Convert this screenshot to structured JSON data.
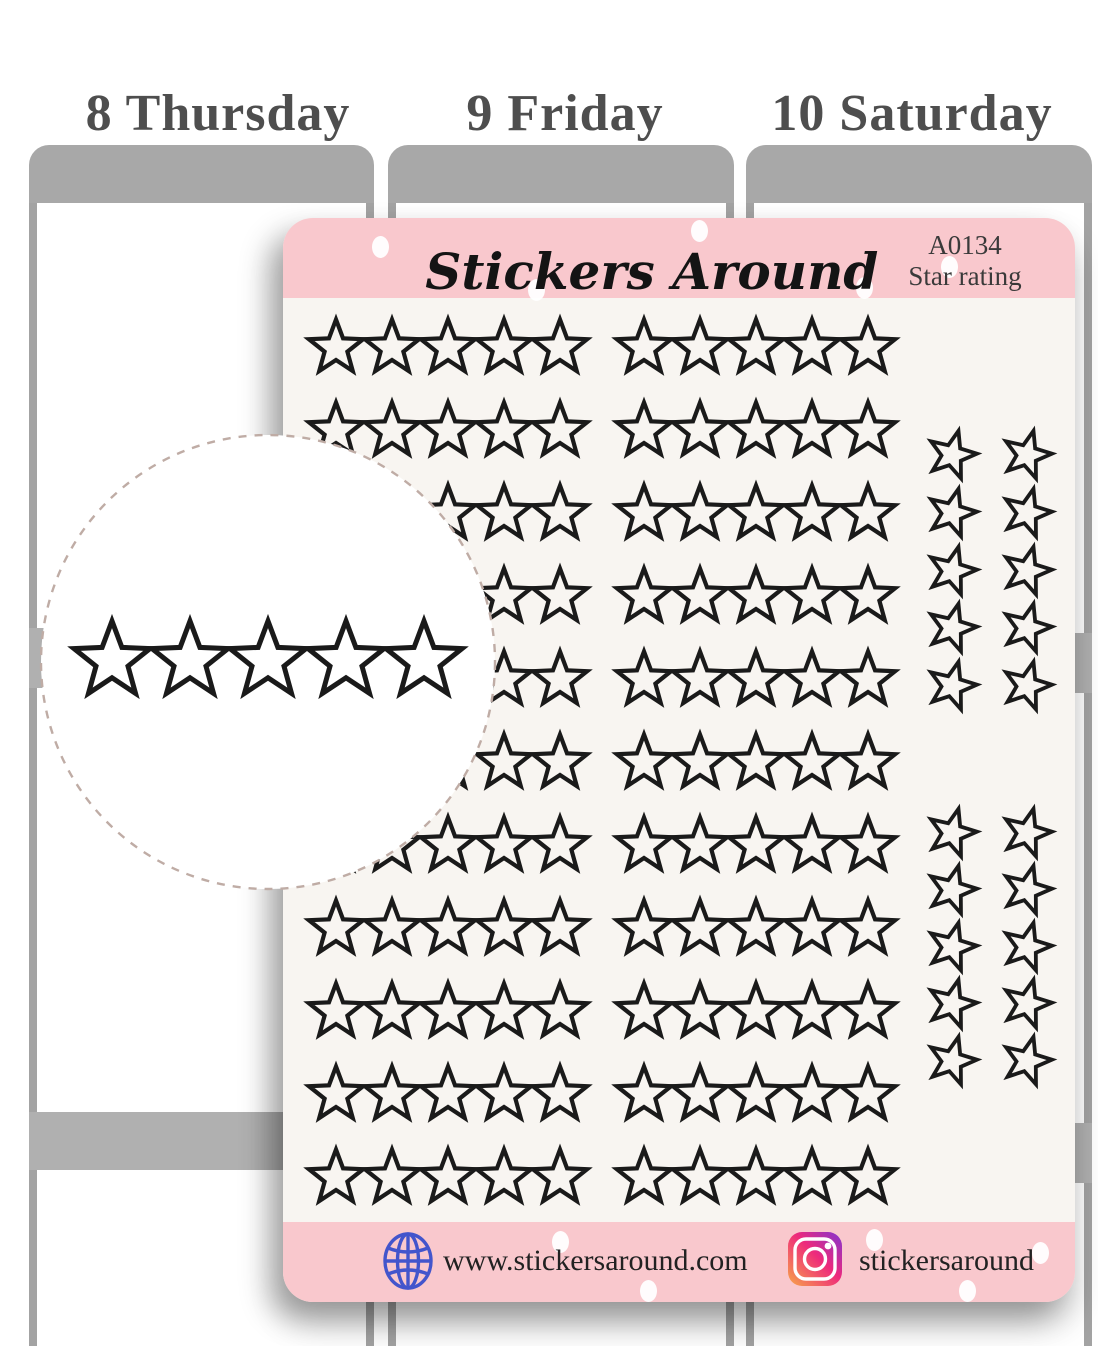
{
  "planner": {
    "days": [
      {
        "label": "8 Thursday"
      },
      {
        "label": "9 Friday"
      },
      {
        "label": "10 Saturday"
      }
    ]
  },
  "sheet": {
    "brand": "Stickers Around",
    "sku": "A0134",
    "product_name": "Star rating",
    "rating_rows": 11,
    "groups_per_row": 2,
    "stars_per_group": 5,
    "side_blocks": 2,
    "side_rows": 5,
    "side_columns": 2,
    "footer": {
      "website": "www.stickersaround.com",
      "instagram_handle": "stickersaround"
    }
  },
  "callout": {
    "star_count": 5
  },
  "colors": {
    "sheet_pink": "#f9c8cd",
    "sheet_cream": "#f8f5f1",
    "star_outline": "#1a1a1a",
    "planner_gray": "#a8a8a8",
    "label_gray": "#4e4e4e",
    "globe_blue": "#4355cc"
  }
}
